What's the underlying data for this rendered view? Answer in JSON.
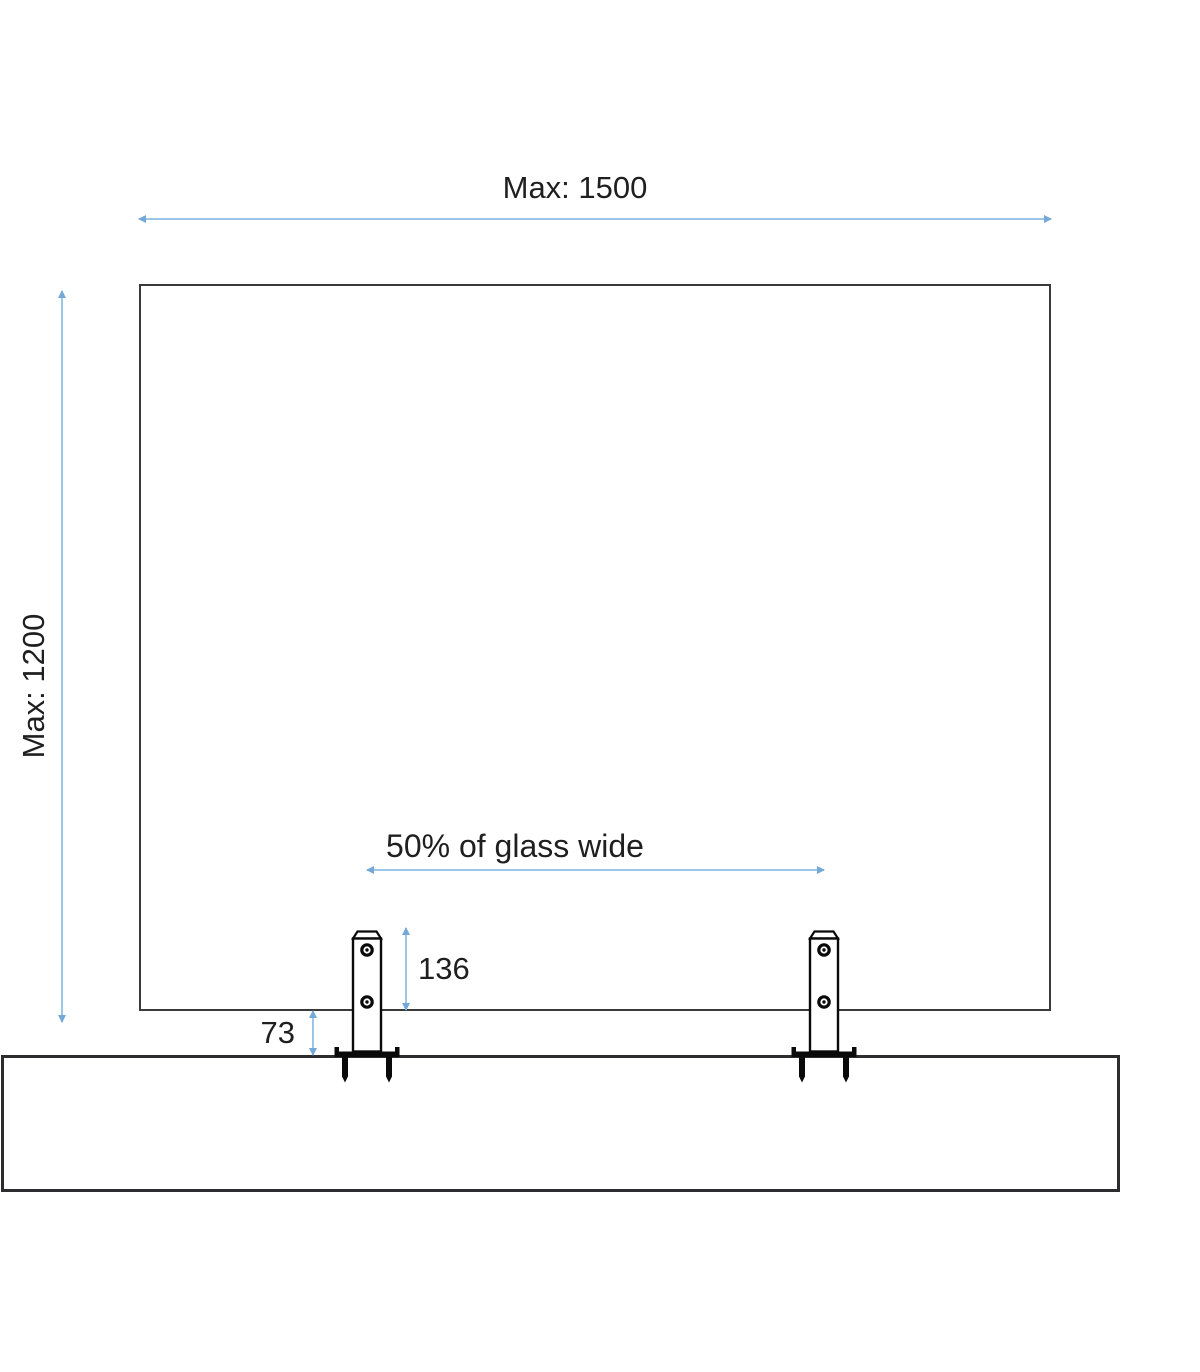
{
  "dimensions": {
    "max_width": {
      "label": "Max: 1500"
    },
    "max_height": {
      "label": "Max: 1200"
    },
    "bracket_spacing": {
      "label": "50% of glass wide"
    },
    "bracket_height": {
      "label": "136"
    },
    "glass_surface_gap": {
      "label": "73"
    }
  },
  "colors": {
    "dimension_line": "#9BC6E9",
    "dimension_arrow": "#74A9D7",
    "glass_outline": "#3A3A3C",
    "surface_outline": "#2D2D2F",
    "bracket_outline": "#0A0A0A",
    "text": "#1F1F1F",
    "background": "#FFFFFF"
  }
}
